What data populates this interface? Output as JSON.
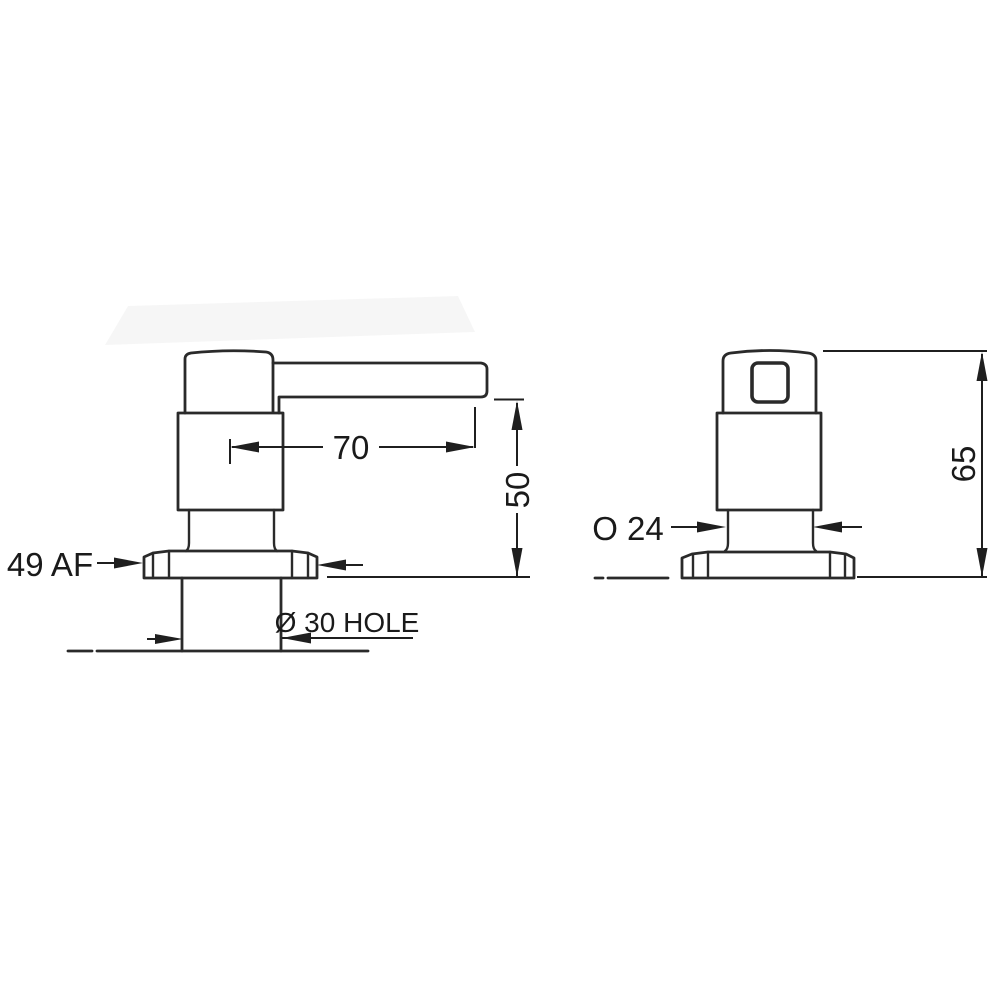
{
  "drawing": {
    "type": "technical-dimension-drawing",
    "views": "two orthographic views of a deck-mounted dispenser/tap",
    "colors": {
      "line": "#2a2a2a",
      "dimension": "#1f1f1f",
      "counter_line": "#9a9a9a",
      "text": "#1a1a1a",
      "background": "#ffffff"
    },
    "side_view": {
      "name": "side view",
      "dim_spout_reach": "70",
      "dim_height_above_deck": "50",
      "dim_across_flats": "49 AF",
      "dim_mounting_hole": "Ø 30 HOLE"
    },
    "front_view": {
      "name": "front view",
      "dim_shank_diameter": "O 24",
      "dim_overall_height": "65"
    }
  }
}
